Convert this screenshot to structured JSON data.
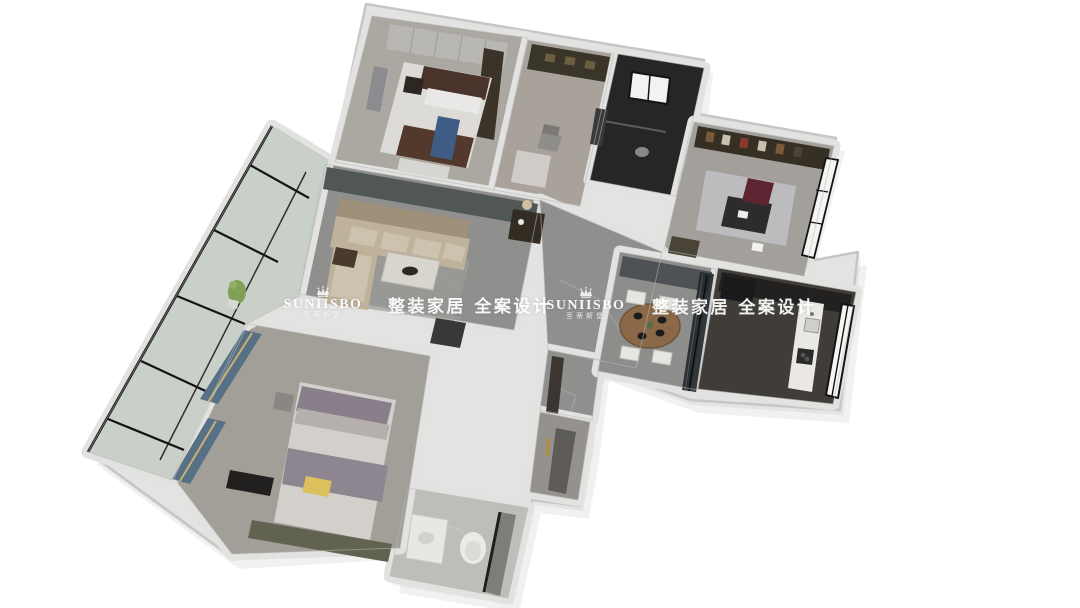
{
  "watermark": {
    "brand": "SUNIISBO",
    "brand_cn": "圣蒂斯堡",
    "slogan": "整装家居 全案设计",
    "color": "#ffffff",
    "occurrences": 2
  },
  "palette": {
    "background": "#ffffff",
    "wall": "#e3e3e1",
    "wall_edge": "#b8b8b6",
    "marble_floor": "#8f8f8d",
    "feature_wall": "#515755",
    "dark_tile": "#262626",
    "kitchen_floor": "#403d39",
    "sofa_beige": "#bfb29b",
    "bed_blanket_brown": "#53392c",
    "accent_blue": "#3f5c85",
    "accent_yellow": "#dcc05e",
    "curtain_blue": "#567086",
    "curtain_trim_gold": "#c9b174",
    "chair_maroon": "#5c2531",
    "cabinet_olive": "#3b3328",
    "balcony_glass": "#c9cfc9",
    "window_frame": "#141414",
    "dining_wood": "#8a6848",
    "plant_green": "#7fa055"
  },
  "icons": {
    "crown": "crown-icon"
  }
}
